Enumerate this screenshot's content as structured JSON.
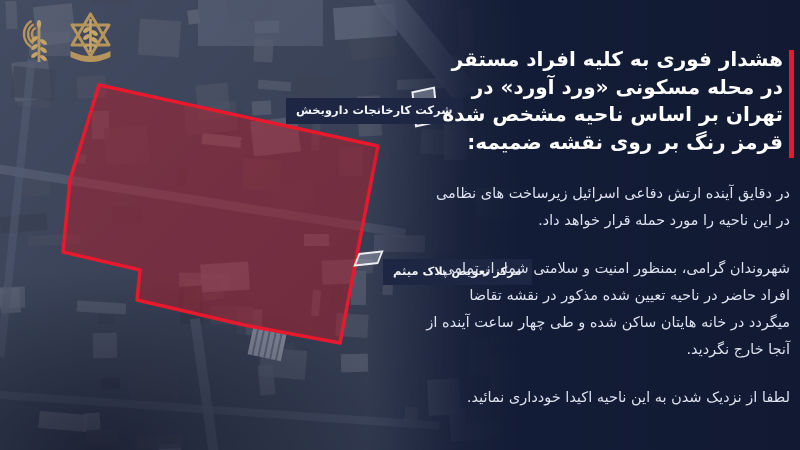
{
  "meta": {
    "language": "fa",
    "direction": "rtl"
  },
  "logos": {
    "spokesperson_icon": "idf-spokesperson-broadcast-branch-emblem",
    "idf_icon": "idf-star-sword-olive-branch-emblem",
    "gold_color": "#b6955c"
  },
  "map": {
    "type": "satellite",
    "zone_border_color": "#e8192c",
    "zone_fill_color": "rgba(198,24,36,0.42)",
    "labels": [
      {
        "text": "شرکت کارخانجات داروبخش"
      },
      {
        "text": "مرکز تعویض پلاک میثم"
      }
    ]
  },
  "panel": {
    "background_color": "#131c36",
    "accent_bar_color": "#e8192c",
    "heading": "هشدار فوری به کلیه افراد مستقر در محله مسکونی «ورد آورد» در تهران بر اساس ناحیه مشخص شده قرمز رنگ بر روی نقشه ضمیمه:",
    "paragraphs": [
      "در دقایق آینده ارتش دفاعی اسرائیل زیرساخت های نظامی در این ناحیه را مورد حمله قرار خواهد داد.",
      "شهروندان گرامی، بمنظور امنیت و سلامتی شما، از تمامی افراد حاضر در ناحیه تعیین شده مذکور در نقشه تقاضا میگردد در خانه هایتان ساکن شده و طی چهار ساعت آینده از آنجا خارج نگردید.",
      "لطفا از نزدیک شدن به این ناحیه اکیدا خودداری نمائید."
    ]
  }
}
